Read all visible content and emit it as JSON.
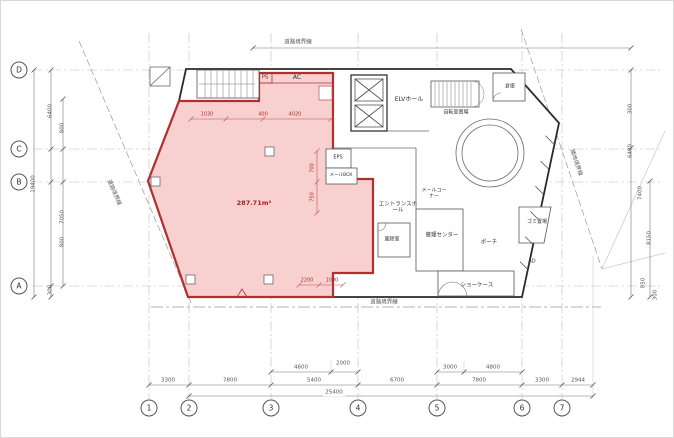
{
  "plan": {
    "area_label": "287.71m²",
    "rooms": {
      "elv_hall": "ELVホール",
      "storage": "倉庫",
      "bicycle": "自転車置場",
      "mail_corner": "メールコーナー",
      "entrance_hall": "エントランスホール",
      "windbreak": "風除室",
      "admin_center": "管理センター",
      "porch": "ポーチ",
      "garbage": "ゴミ置場",
      "showcase": "ショーケース"
    },
    "marks": {
      "ac": "AC",
      "ps": "PS",
      "ad": "AD",
      "eps": "EPS",
      "mail_box": "メールBOX"
    },
    "boundaries": {
      "top": "道路境界線",
      "bottom": "道路境界線",
      "left": "道路境界線",
      "right": "隣地境界線"
    }
  },
  "grid": {
    "rows": [
      "D",
      "C",
      "B",
      "A"
    ],
    "cols": [
      "1",
      "2",
      "3",
      "4",
      "5",
      "6",
      "7"
    ]
  },
  "dims": {
    "top_sub": [
      "4600",
      "2000",
      "3000",
      "4800"
    ],
    "main": [
      "3300",
      "7800",
      "5400",
      "6700",
      "7800",
      "3300",
      "2944"
    ],
    "total": "25400",
    "left": [
      "6400",
      "800",
      "19400",
      "7050",
      "800",
      "300"
    ],
    "right": [
      "300",
      "6400",
      "7400",
      "8150",
      "850",
      "300"
    ],
    "red": [
      "1030",
      "400",
      "4020",
      "700",
      "750",
      "2200",
      "1000"
    ]
  },
  "colors": {
    "highlight_fill": "#f4a9a9",
    "highlight_border": "#b03030",
    "line": "#444444"
  }
}
